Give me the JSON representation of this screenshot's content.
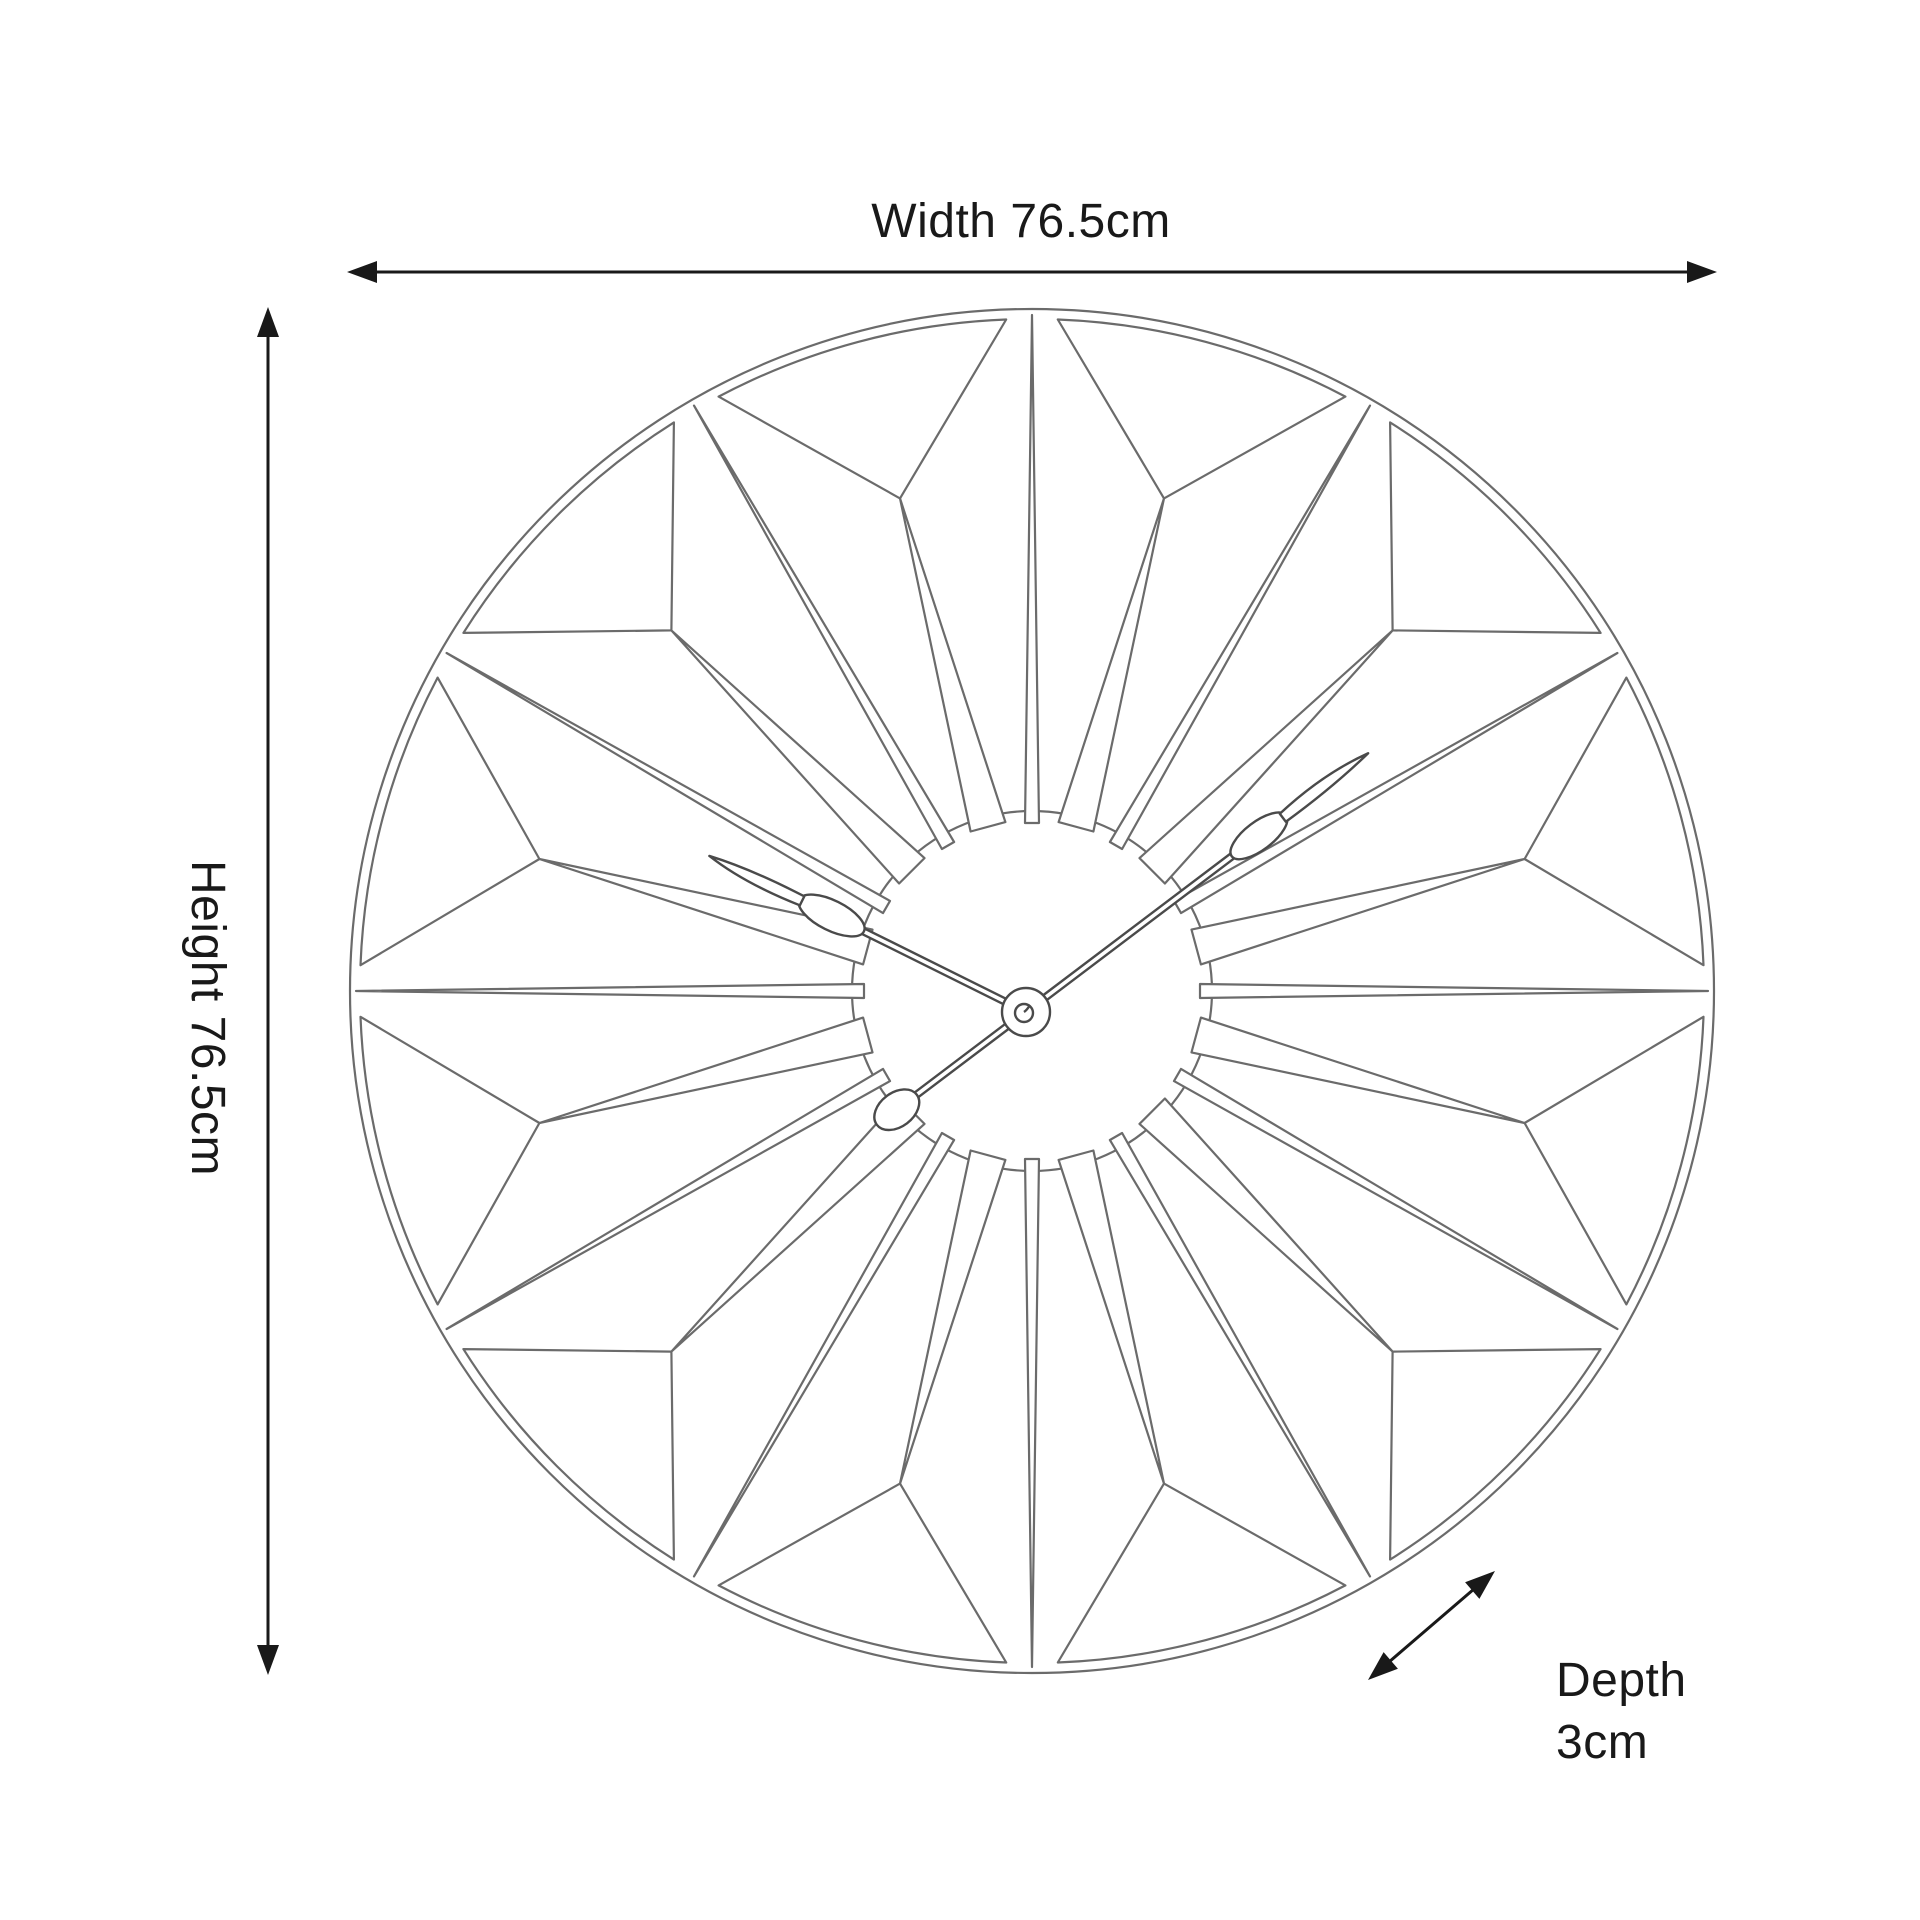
{
  "diagram": {
    "subject": "geometric-sunburst-skeleton-wall-clock-line-drawing",
    "dimensions": {
      "width_label": "Width 76.5cm",
      "height_label": "Height 76.5cm",
      "depth_label_line1": "Depth",
      "depth_label_line2": "3cm"
    },
    "colors": {
      "background": "#ffffff",
      "artwork_line": "#6b6b6b",
      "hand_line": "#4a4a4a",
      "dimension": "#191919"
    }
  }
}
